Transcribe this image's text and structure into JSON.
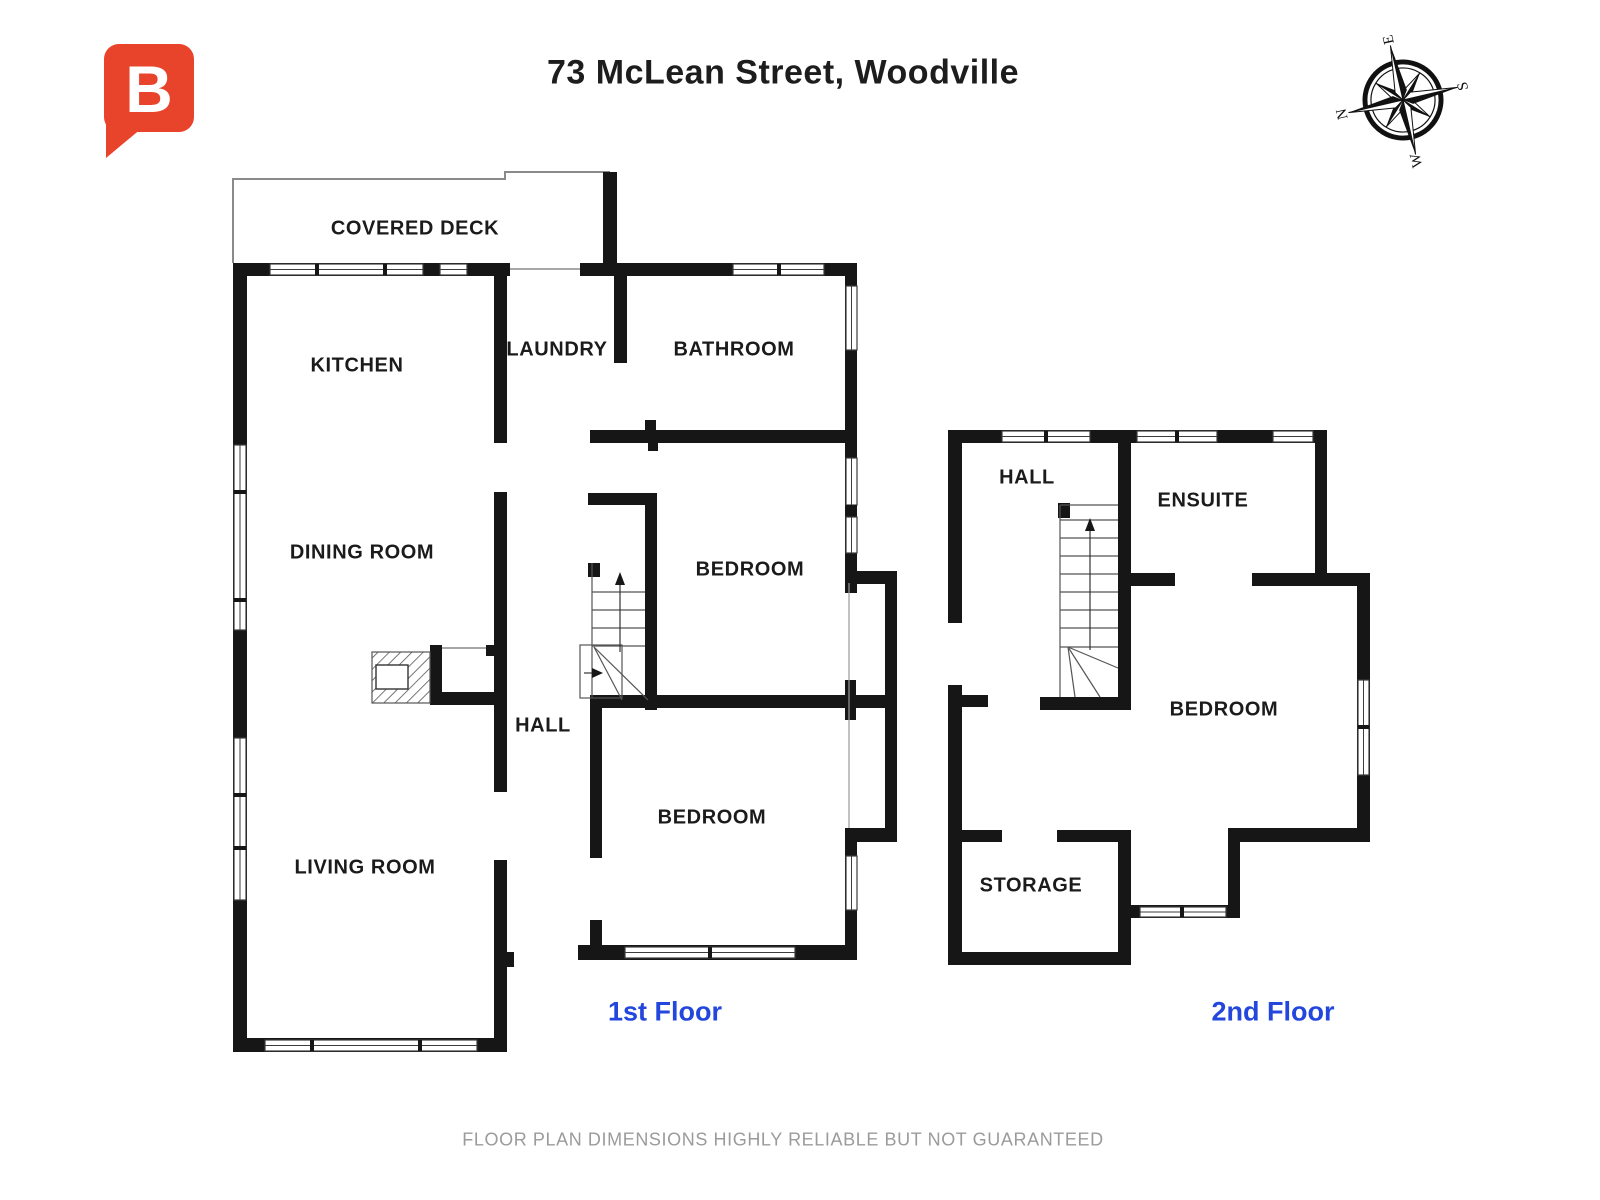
{
  "page": {
    "title": "73 McLean Street, Woodville"
  },
  "logo": {
    "letter": "B",
    "color": "#e8432b"
  },
  "compass": {
    "north": "N",
    "east": "E",
    "south": "S",
    "west": "W"
  },
  "floor1": {
    "label": "1st Floor",
    "rooms": {
      "covered_deck": "COVERED DECK",
      "kitchen": "KITCHEN",
      "laundry": "LAUNDRY",
      "bathroom": "BATHROOM",
      "dining_room": "DINING ROOM",
      "bedroom_upper": "BEDROOM",
      "hall": "HALL",
      "bedroom_lower": "BEDROOM",
      "living_room": "LIVING ROOM"
    }
  },
  "floor2": {
    "label": "2nd Floor",
    "rooms": {
      "hall": "HALL",
      "ensuite": "ENSUITE",
      "bedroom": "BEDROOM",
      "storage": "STORAGE"
    }
  },
  "footer": {
    "disclaimer": "FLOOR PLAN DIMENSIONS HIGHLY RELIABLE BUT NOT GUARANTEED"
  },
  "colors": {
    "wall": "#161616",
    "floor_label_blue": "#2347dd",
    "logo_red": "#e8432b",
    "footer_gray": "#9b9b9b",
    "deck_outline": "#8a8a8a"
  }
}
